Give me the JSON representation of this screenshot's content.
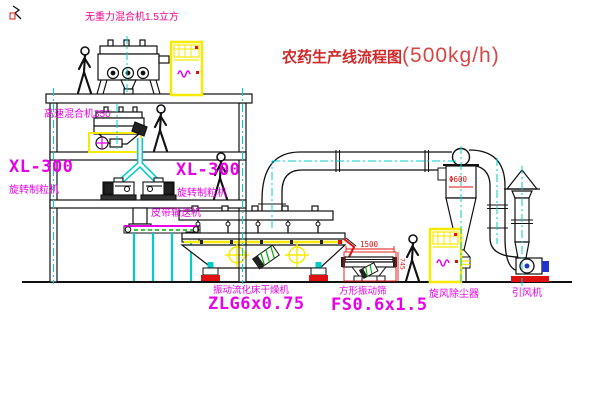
{
  "title": {
    "name": "农药生产线流程图",
    "capacity": "(500kg/h)"
  },
  "labels": {
    "gravity_mixer": "无重力混合机1.5立方",
    "high_speed_mixer": "高速混合机350",
    "granulator_model_left": "XL-300",
    "granulator_name_left": "旋转制粒机",
    "granulator_model_mid": "XL-300",
    "granulator_name_mid": "旋转制粒机",
    "belt_conveyor": "皮带输送机",
    "dryer_name": "振动流化床干燥机",
    "dryer_model": "ZLG6x0.75",
    "sieve_name": "方形振动筛",
    "sieve_model": "FS0.6x1.5",
    "cyclone": "旋风除尘器",
    "fan": "引风机"
  },
  "dimensions": {
    "sieve_length": "1500",
    "sieve_height": "745",
    "cyclone_body": "Φ600"
  },
  "colors": {
    "label_magenta": "#e800e8",
    "label_pink": "#f4008c",
    "title_red": "#cf2a2a",
    "dimension_red": "#e01010",
    "centerline_cyan": "#00cfcf",
    "highlight_yellow": "#f5ea00",
    "detail_green": "#00aa00",
    "fan_blue": "#2233cc",
    "line_black": "#111111"
  },
  "icons": {
    "person_figure": "walking-person",
    "rain_cap": "chimney-rain-cap"
  },
  "people_count": 4
}
